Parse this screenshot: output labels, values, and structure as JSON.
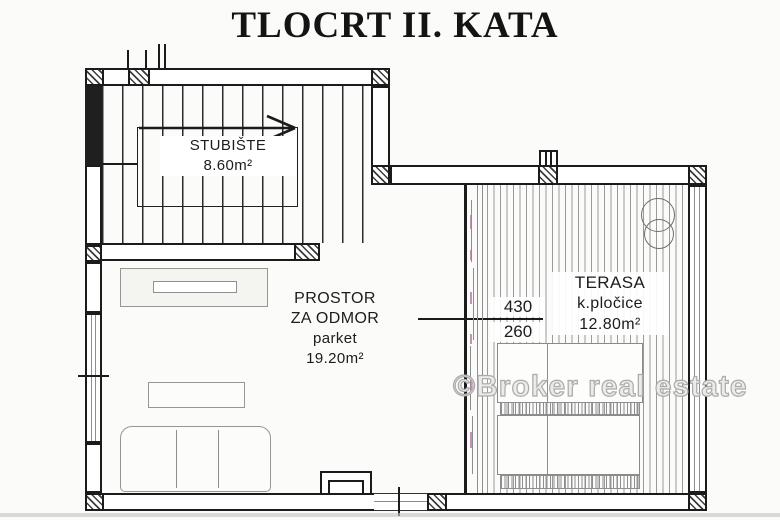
{
  "title": "TLOCRT II. KATA",
  "watermark": "©Broker real estate",
  "rooms": {
    "staircase": {
      "name": "STUBIŠTE",
      "area": "8.60m²"
    },
    "lounge": {
      "line1": "PROSTOR",
      "line2": "ZA ODMOR",
      "floor": "parket",
      "area": "19.20m²"
    },
    "terrace": {
      "name": "TERASA",
      "floor": "k.pločice",
      "area": "12.80m²"
    }
  },
  "dimensions": {
    "width_cm": "430",
    "depth_cm": "260"
  },
  "colors": {
    "ink": "#1b1b1b",
    "furniture_line": "#969692",
    "watermark_outline": "#ababab",
    "paper": "#fbfbf9"
  }
}
